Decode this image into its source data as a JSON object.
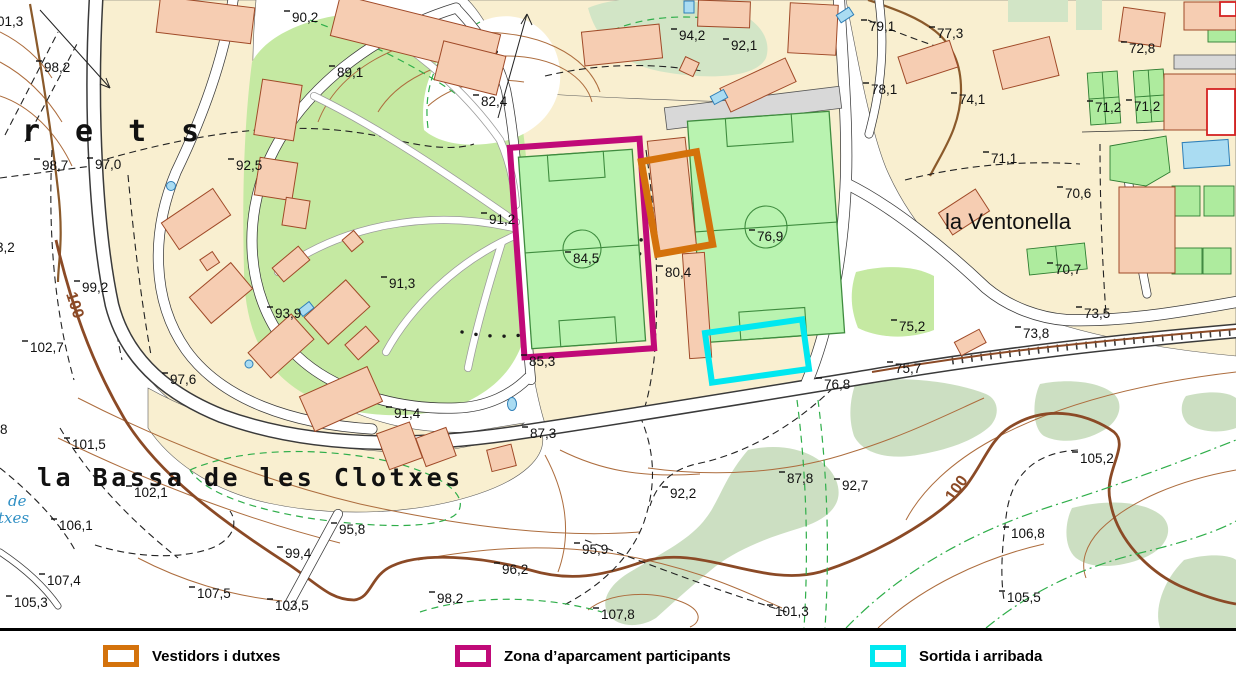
{
  "legend": {
    "items": [
      {
        "label": "Vestidors i dutxes",
        "color": "#d4720b"
      },
      {
        "label": "Zona d’aparcament participants",
        "color": "#c00a78"
      },
      {
        "label": "Sortida i arribada",
        "color": "#00e8f0"
      }
    ]
  },
  "map": {
    "place_names": {
      "rets_fragment": "rets",
      "bassa": "la Bassa de les Clotxes",
      "ventonella": "la Ventonella",
      "water_fragment_1": "de",
      "water_fragment_2": "txes"
    },
    "contour_index_labels": [
      "100",
      "100"
    ],
    "annotations": {
      "vestidors": {
        "color": "#d4720b"
      },
      "aparcament": {
        "color": "#c00a78"
      },
      "sortida": {
        "color": "#00e8f0"
      }
    },
    "colors": {
      "parcel": "#f9efd0",
      "park": "#c5e9a2",
      "field": "#b9f3b0",
      "building": "#f6cdb2",
      "water": "#aadcf2",
      "contour": "#ad6d3e",
      "vegetation": "#ccdfc2"
    },
    "spot_elevations": [
      {
        "x": 44,
        "y": 72,
        "v": "98,2"
      },
      {
        "x": 292,
        "y": 22,
        "v": "90,2"
      },
      {
        "x": 337,
        "y": 77,
        "v": "89,1"
      },
      {
        "x": 481,
        "y": 106,
        "v": "82,4"
      },
      {
        "x": 679,
        "y": 40,
        "v": "94,2"
      },
      {
        "x": 731,
        "y": 50,
        "v": "92,1"
      },
      {
        "x": 869,
        "y": 31,
        "v": "79,1"
      },
      {
        "x": 937,
        "y": 38,
        "v": "77,3"
      },
      {
        "x": 1129,
        "y": 53,
        "v": "72,8"
      },
      {
        "x": 871,
        "y": 94,
        "v": "78,1"
      },
      {
        "x": 959,
        "y": 104,
        "v": "74,1"
      },
      {
        "x": 1095,
        "y": 112,
        "v": "71,2"
      },
      {
        "x": 1134,
        "y": 111,
        "v": "71,2"
      },
      {
        "x": 991,
        "y": 163,
        "v": "71,1"
      },
      {
        "x": 1065,
        "y": 198,
        "v": "70,6"
      },
      {
        "x": 1055,
        "y": 274,
        "v": "70,7"
      },
      {
        "x": 42,
        "y": 170,
        "v": "98,7"
      },
      {
        "x": 95,
        "y": 169,
        "v": "97,0"
      },
      {
        "x": 236,
        "y": 170,
        "v": "92,5"
      },
      {
        "x": -4,
        "y": 252,
        "v": "3,2"
      },
      {
        "x": 82,
        "y": 292,
        "v": "99,2"
      },
      {
        "x": 30,
        "y": 352,
        "v": "102,7"
      },
      {
        "x": 489,
        "y": 224,
        "v": "91,2"
      },
      {
        "x": 573,
        "y": 263,
        "v": "84,5"
      },
      {
        "x": 757,
        "y": 241,
        "v": "76,9"
      },
      {
        "x": 665,
        "y": 277,
        "v": "80,4"
      },
      {
        "x": 389,
        "y": 288,
        "v": "91,3"
      },
      {
        "x": 275,
        "y": 318,
        "v": "93,9"
      },
      {
        "x": 170,
        "y": 384,
        "v": "97,6"
      },
      {
        "x": 899,
        "y": 331,
        "v": "75,2"
      },
      {
        "x": 1023,
        "y": 338,
        "v": "73,8"
      },
      {
        "x": 1084,
        "y": 318,
        "v": "73,5"
      },
      {
        "x": 895,
        "y": 373,
        "v": "75,7"
      },
      {
        "x": 824,
        "y": 389,
        "v": "76,8"
      },
      {
        "x": 529,
        "y": 366,
        "v": "85,3"
      },
      {
        "x": 394,
        "y": 418,
        "v": "91,4"
      },
      {
        "x": 530,
        "y": 438,
        "v": "87,3"
      },
      {
        "x": 72,
        "y": 449,
        "v": "101,5"
      },
      {
        "x": 134,
        "y": 497,
        "v": "102,1"
      },
      {
        "x": 59,
        "y": 530,
        "v": "106,1"
      },
      {
        "x": 47,
        "y": 585,
        "v": "107,4"
      },
      {
        "x": 14,
        "y": 607,
        "v": "105,3"
      },
      {
        "x": 197,
        "y": 598,
        "v": "107,5"
      },
      {
        "x": 275,
        "y": 610,
        "v": "103,5"
      },
      {
        "x": 437,
        "y": 603,
        "v": "98,2"
      },
      {
        "x": 339,
        "y": 534,
        "v": "95,8"
      },
      {
        "x": 285,
        "y": 558,
        "v": "99,4"
      },
      {
        "x": 582,
        "y": 554,
        "v": "95,9"
      },
      {
        "x": 502,
        "y": 574,
        "v": "96,2"
      },
      {
        "x": 670,
        "y": 498,
        "v": "92,2"
      },
      {
        "x": 787,
        "y": 483,
        "v": "87,8"
      },
      {
        "x": 842,
        "y": 490,
        "v": "92,7"
      },
      {
        "x": 1080,
        "y": 463,
        "v": "105,2"
      },
      {
        "x": 1011,
        "y": 538,
        "v": "106,8"
      },
      {
        "x": 1007,
        "y": 602,
        "v": "105,5"
      },
      {
        "x": 775,
        "y": 616,
        "v": "101,3"
      },
      {
        "x": 601,
        "y": 619,
        "v": "107,8"
      },
      {
        "x": -3,
        "y": 26,
        "v": "01,3"
      },
      {
        "x": 0,
        "y": 434,
        "v": "8"
      }
    ]
  }
}
